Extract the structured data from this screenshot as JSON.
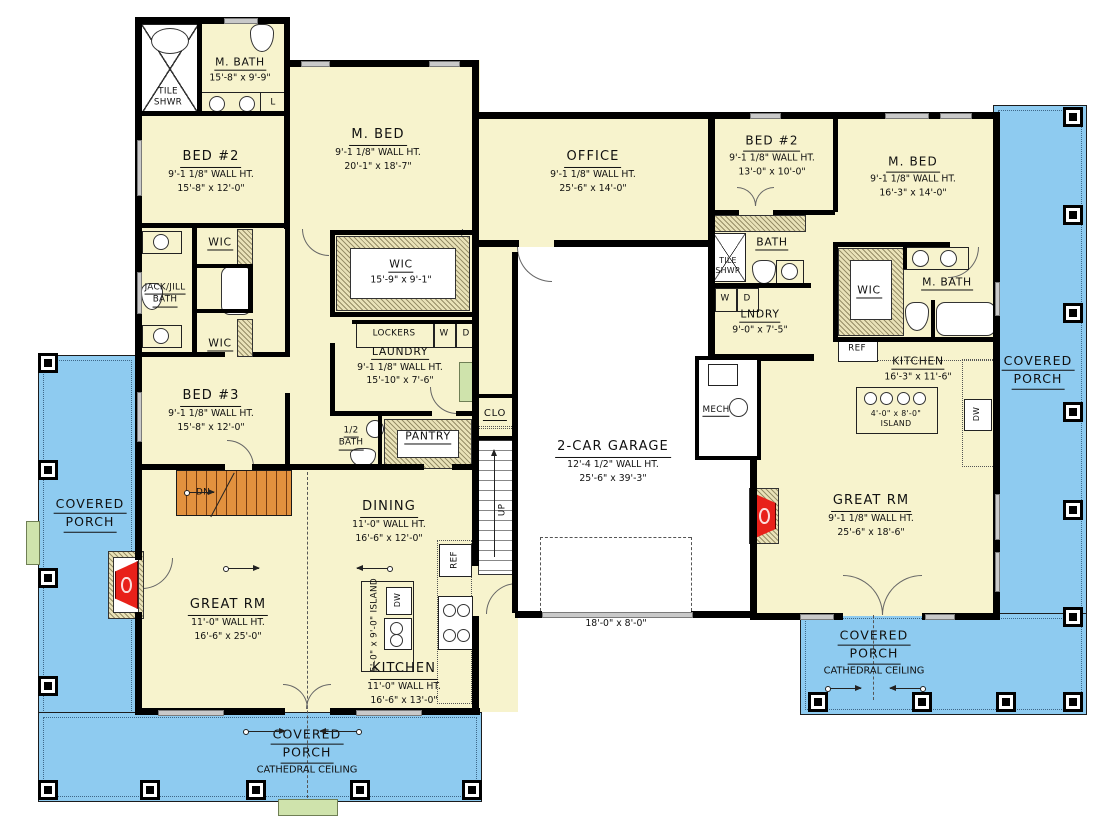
{
  "palette": {
    "floor": "#f7f3cd",
    "porch": "#8ecbf0",
    "wall": "#000000",
    "stair": "#e2913e",
    "step": "#cfe3ac",
    "fireplace": "#e8211a",
    "hatch": "#e9e2b8"
  },
  "rooms": {
    "m_bath_left": {
      "title": "M. BATH",
      "d1": "15'-8\" x 9'-9\""
    },
    "tile_shwr_left": {
      "l1": "TILE",
      "l2": "SHWR"
    },
    "linen": {
      "t": "L"
    },
    "bed2_left": {
      "title": "BED #2",
      "d1": "9'-1 1/8\" WALL HT.",
      "d2": "15'-8\" x 12'-0\""
    },
    "m_bed_left": {
      "title": "M. BED",
      "d1": "9'-1 1/8\" WALL HT.",
      "d2": "20'-1\" x 18'-7\""
    },
    "wic_top": {
      "title": "WIC"
    },
    "jack_jill": {
      "l1": "JACK/JILL",
      "l2": "BATH"
    },
    "wic_bottom": {
      "title": "WIC"
    },
    "bed3": {
      "title": "BED #3",
      "d1": "9'-1 1/8\" WALL HT.",
      "d2": "15'-8\" x 12'-0\""
    },
    "wic_big": {
      "title": "WIC",
      "d1": "15'-9\" x 9'-1\""
    },
    "lockers": {
      "title": "LOCKERS",
      "w": "W",
      "d": "D"
    },
    "laundry_left": {
      "title": "LAUNDRY",
      "d1": "9'-1 1/8\" WALL HT.",
      "d2": "15'-10\" x 7'-6\""
    },
    "half_bath": {
      "l1": "1/2",
      "l2": "BATH"
    },
    "pantry": {
      "title": "PANTRY"
    },
    "clo": {
      "title": "CLO"
    },
    "up": {
      "t": "UP"
    },
    "dn": {
      "t": "DN"
    },
    "office": {
      "title": "OFFICE",
      "d1": "9'-1 1/8\" WALL HT.",
      "d2": "25'-6\" x 14'-0\""
    },
    "garage": {
      "title": "2-CAR GARAGE",
      "d1": "12'-4 1/2\" WALL HT.",
      "d2": "25'-6\" x 39'-3\"",
      "door": "18'-0\" x 8'-0\""
    },
    "mech": {
      "title": "MECH"
    },
    "bed2_right": {
      "title": "BED #2",
      "d1": "9'-1 1/8\" WALL HT.",
      "d2": "13'-0\" x 10'-0\""
    },
    "bath_right": {
      "title": "BATH"
    },
    "tile_shwr_right": {
      "l1": "TILE",
      "l2": "SHWR"
    },
    "wd": {
      "w": "W",
      "d": "D"
    },
    "lndry_right": {
      "title": "LNDRY",
      "d1": "9'-0\" x 7'-5\""
    },
    "m_bed_right": {
      "title": "M. BED",
      "d1": "9'-1 1/8\" WALL HT.",
      "d2": "16'-3\" x 14'-0\""
    },
    "wic_right": {
      "title": "WIC"
    },
    "m_bath_right": {
      "title": "M. BATH"
    },
    "kitchen_right": {
      "title": "KITCHEN",
      "d1": "16'-3\" x 11'-6\""
    },
    "island_right": {
      "l1": "4'-0\" x 8'-0\"",
      "l2": "ISLAND"
    },
    "great_rm_right": {
      "title": "GREAT RM",
      "d1": "9'-1 1/8\" WALL HT.",
      "d2": "25'-6\" x 18'-6\""
    },
    "dining": {
      "title": "DINING",
      "d1": "11'-0\" WALL HT.",
      "d2": "16'-6\" x 12'-0\""
    },
    "great_rm_left": {
      "title": "GREAT RM",
      "d1": "11'-0\" WALL HT.",
      "d2": "16'-6\" x 25'-0\""
    },
    "kitchen_left": {
      "title": "KITCHEN",
      "d1": "11'-0\" WALL HT.",
      "d2": "16'-6\" x 13'-0\""
    },
    "island_left": {
      "t": "5'-0\" x 9'-0\" ISLAND"
    },
    "ref": {
      "t": "REF"
    },
    "dw": {
      "t": "DW"
    },
    "porch_left": {
      "l1": "COVERED",
      "l2": "PORCH"
    },
    "porch_bottom": {
      "l1": "COVERED",
      "l2": "PORCH",
      "cat": "CATHEDRAL CEILING"
    },
    "porch_right": {
      "l1": "COVERED",
      "l2": "PORCH"
    },
    "porch_bottom_right": {
      "l1": "COVERED",
      "l2": "PORCH",
      "cat": "CATHEDRAL CEILING"
    }
  }
}
